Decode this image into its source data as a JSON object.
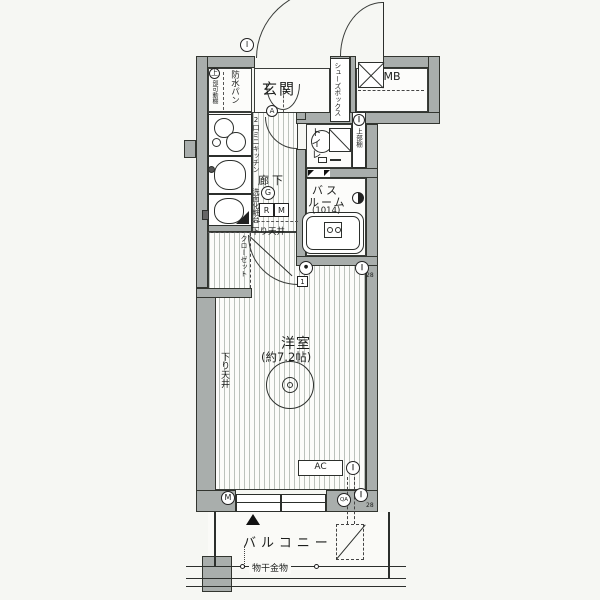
{
  "colors": {
    "wall": "#a9aeac",
    "line": "#2c2f2c",
    "bg": "#f6f7f3",
    "floor": "#fcfcfa"
  },
  "plan": {
    "rooms": {
      "genkan": "玄関",
      "shoes_box": "シューズボックス",
      "mb": "MB",
      "bousui_pan": "防水パン",
      "toilet": "トイレ",
      "bath_line1": "バス",
      "bath_line2": "ルーム",
      "bath_size": "(1014)",
      "corridor": "廊下",
      "closet": "クローゼット",
      "room": "洋室",
      "room_size": "(約7.2帖)",
      "balcony": "バルコニー",
      "ac": "AC"
    },
    "notes": {
      "kitchen": "2口ミニキッチン",
      "vanity": "洗面化粧台",
      "upper_shelf_mark": "上",
      "upper_shelf_small": "部可動棚",
      "toilet_shelf": "上部棚",
      "lowered_ceiling_1": "下り天井",
      "lowered_ceiling_2": "下り天井",
      "laundry_hw": "物干金物"
    },
    "marks": {
      "i": "I",
      "a": "A",
      "g": "G",
      "m": "M",
      "qa": "QA",
      "r_box": "R",
      "m_box": "M",
      "one_box": "1",
      "n28a": "28",
      "n28b": "28",
      "bars": "‖",
      "dot": "●"
    }
  }
}
